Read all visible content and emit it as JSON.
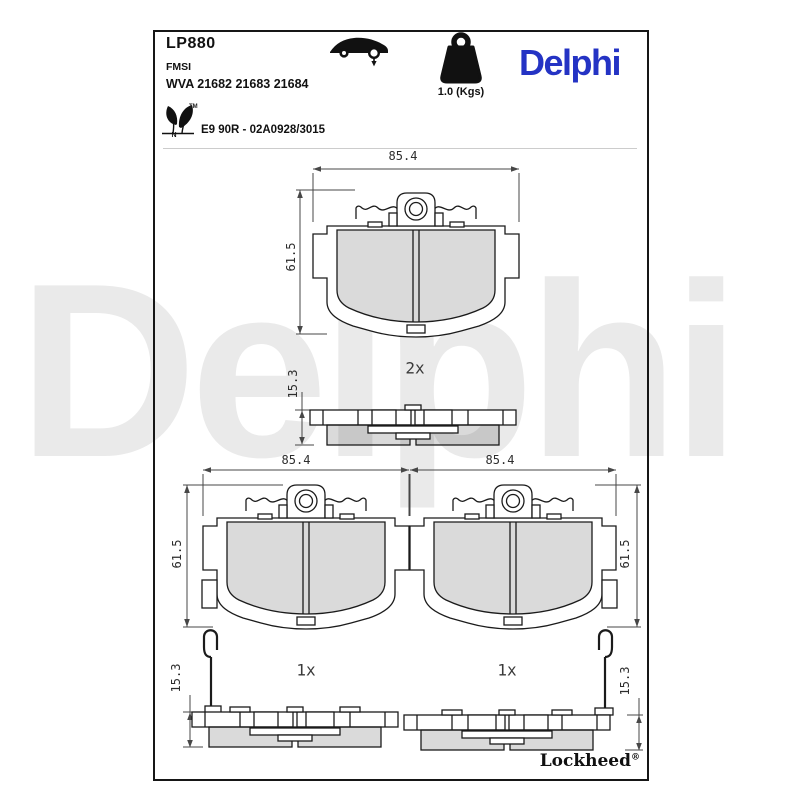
{
  "header": {
    "part_number": "LP880",
    "fmsi_label": "FMSI",
    "wva_numbers": "WVA 21682 21683 21684",
    "weight": "1.0 (Kgs)",
    "brand_logo": "Delphi",
    "homologation": "E9 90R - 02A0928/3015",
    "eco_mark_letter": "N",
    "eco_mark_tm": "TM"
  },
  "drawings": {
    "top": {
      "quantity": "2x",
      "width": "85.4",
      "height": "61.5",
      "thickness": "15.3"
    },
    "bottom_left": {
      "quantity": "1x",
      "width": "85.4",
      "height": "61.5",
      "thickness": "15.3"
    },
    "bottom_right": {
      "quantity": "1x",
      "width": "85.4",
      "height": "61.5",
      "thickness": "15.3"
    }
  },
  "footer": {
    "sub_brand": "Lockheed",
    "registered": "®"
  },
  "watermark": "Delphi",
  "icons": [
    "car-side-icon",
    "weight-kettlebell-icon",
    "eco-leaf-icon"
  ],
  "colors": {
    "brand_blue": "#2433c4",
    "line_black": "#1b1b1b",
    "dimension_gray": "#474747",
    "friction_gray": "#d9d9d9",
    "watermark_gray": "#eaeaea"
  }
}
